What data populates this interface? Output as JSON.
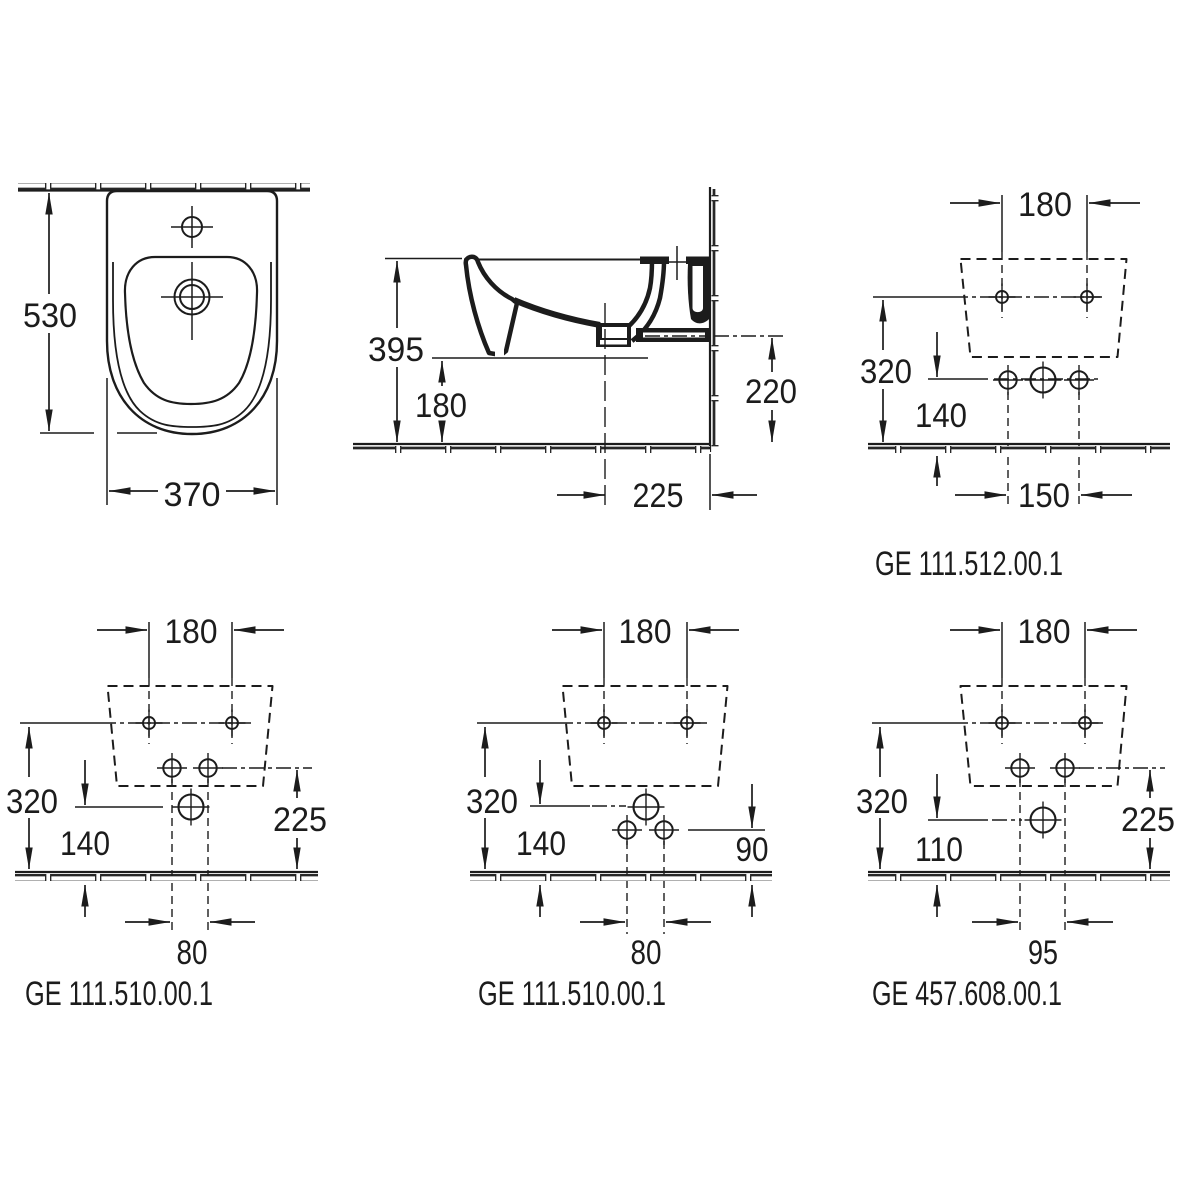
{
  "drawing_title": "Wall-hung bidet installation dimensions",
  "colors": {
    "line": "#1c1c1c",
    "background": "#ffffff"
  },
  "top_view": {
    "depth": "530",
    "width": "370"
  },
  "side_view": {
    "height": "395",
    "underside_height": "180",
    "outlet_height": "220",
    "drain_to_wall": "225"
  },
  "template_top_right": {
    "hole_spacing": "180",
    "fixing_height": "320",
    "connection_height": "140",
    "connection_spacing": "150",
    "label": "GE 111.512.00.1"
  },
  "template_bottom_left": {
    "hole_spacing": "180",
    "fixing_height": "320",
    "drain_height": "140",
    "connection_height": "225",
    "connection_spacing": "80",
    "label": "GE 111.510.00.1"
  },
  "template_bottom_middle": {
    "hole_spacing": "180",
    "fixing_height": "320",
    "drain_height": "140",
    "connection_height": "90",
    "connection_spacing": "80",
    "label": "GE 111.510.00.1"
  },
  "template_bottom_right": {
    "hole_spacing": "180",
    "fixing_height": "320",
    "drain_height": "110",
    "connection_height": "225",
    "connection_spacing": "95",
    "label": "GE 457.608.00.1"
  }
}
